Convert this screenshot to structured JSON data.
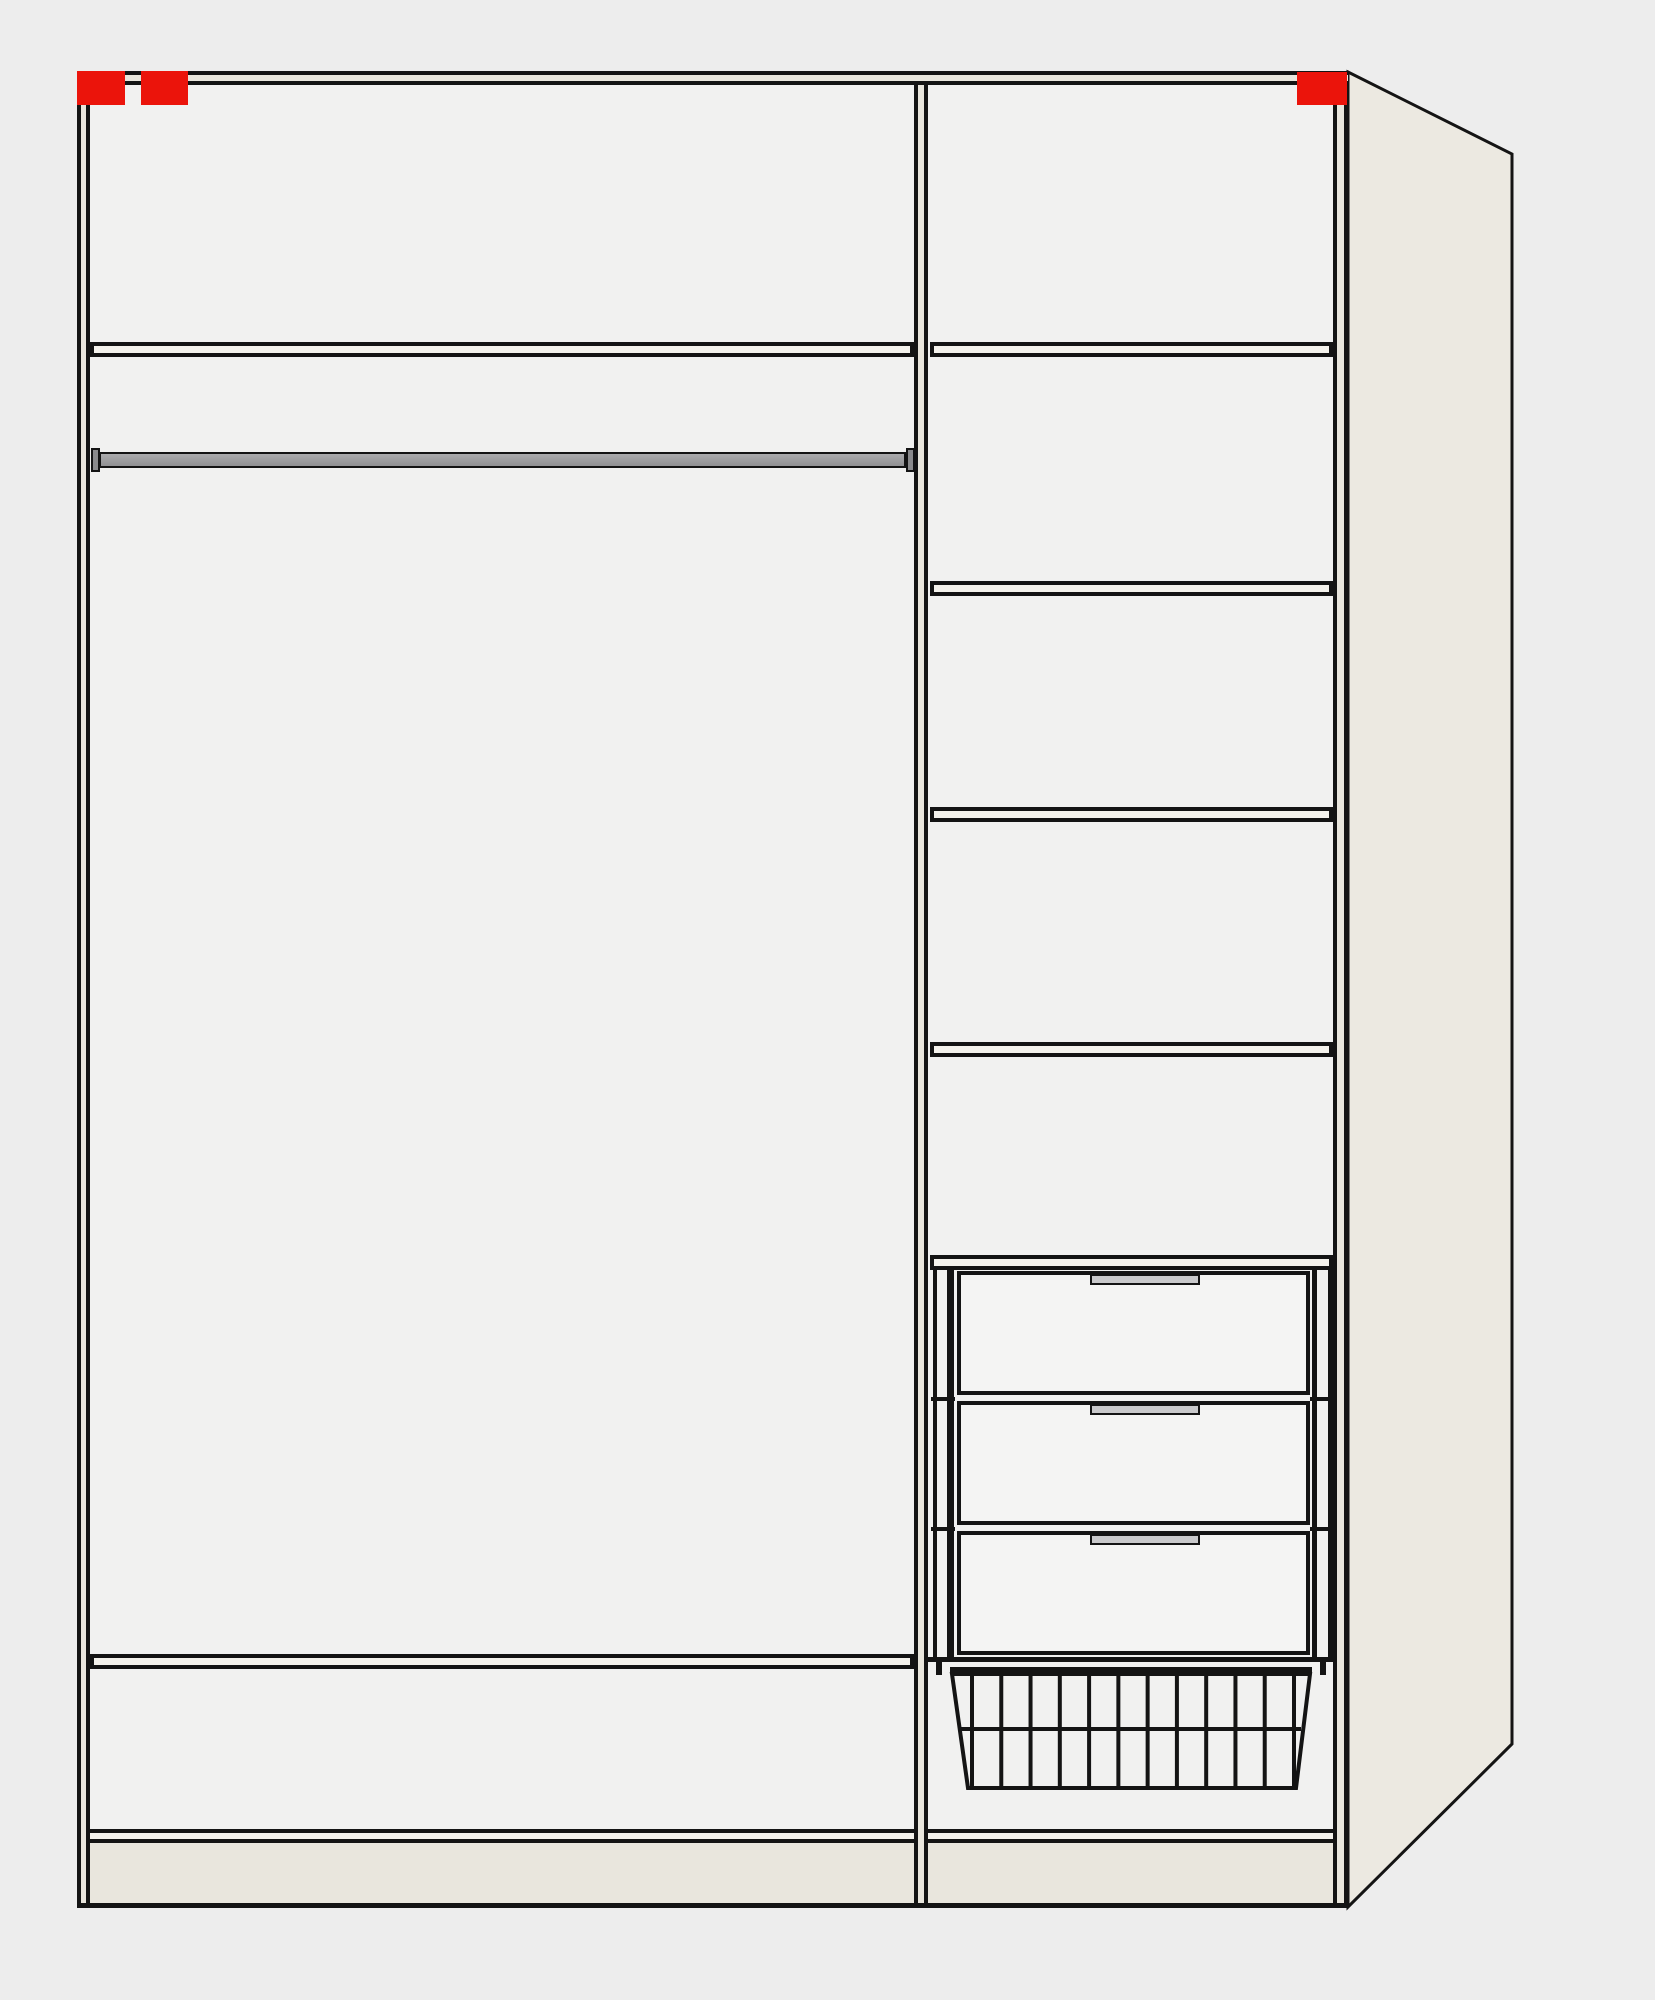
{
  "diagram": {
    "title": "wardrobe-interior-configuration-preview",
    "description": "Front view of a two-column wardrobe carcass with perspective right side panel",
    "left_column": {
      "compartments": [
        "top-shelf-compartment",
        "hanging-area-with-clothes-rail",
        "open-compartment",
        "bottom-compartment"
      ],
      "has_clothes_rail": true,
      "shelf_count": 2
    },
    "right_column": {
      "shelf_count": 5,
      "drawer_count": 3,
      "has_wire_basket": true
    },
    "markers": [
      {
        "id": "top-left-a"
      },
      {
        "id": "top-left-b"
      },
      {
        "id": "top-right"
      }
    ]
  },
  "colors": {
    "background": "#ededed",
    "interior": "#f1f1f0",
    "line": "#141414",
    "edge_fill": "#e9e6dd",
    "shelf_fill": "#f4f2ec",
    "panel_fill": "#ece9e1",
    "plinth_fill": "#e9e6dd",
    "rail_fill": "#98989a",
    "rail_cap": "#8a8a8c",
    "drawer_fill": "#f4f4f3",
    "handle_fill": "#c9c9cb",
    "marker_red": "#eb140b"
  },
  "geometry": {
    "left_shelf_tops": [
      342,
      1654
    ],
    "right_shelf_tops": [
      342,
      581,
      807,
      1042,
      1255
    ],
    "bottom_shelf_top": 1829,
    "drawer_tops": [
      1271,
      1401,
      1531
    ],
    "drawer_tick_tops": [
      1397,
      1527
    ],
    "basket": {
      "bar_count": 12,
      "bar_x_start": 972,
      "bar_x_end": 1294,
      "bar_y_top": 1674,
      "bar_y_bottom": 1788
    }
  }
}
